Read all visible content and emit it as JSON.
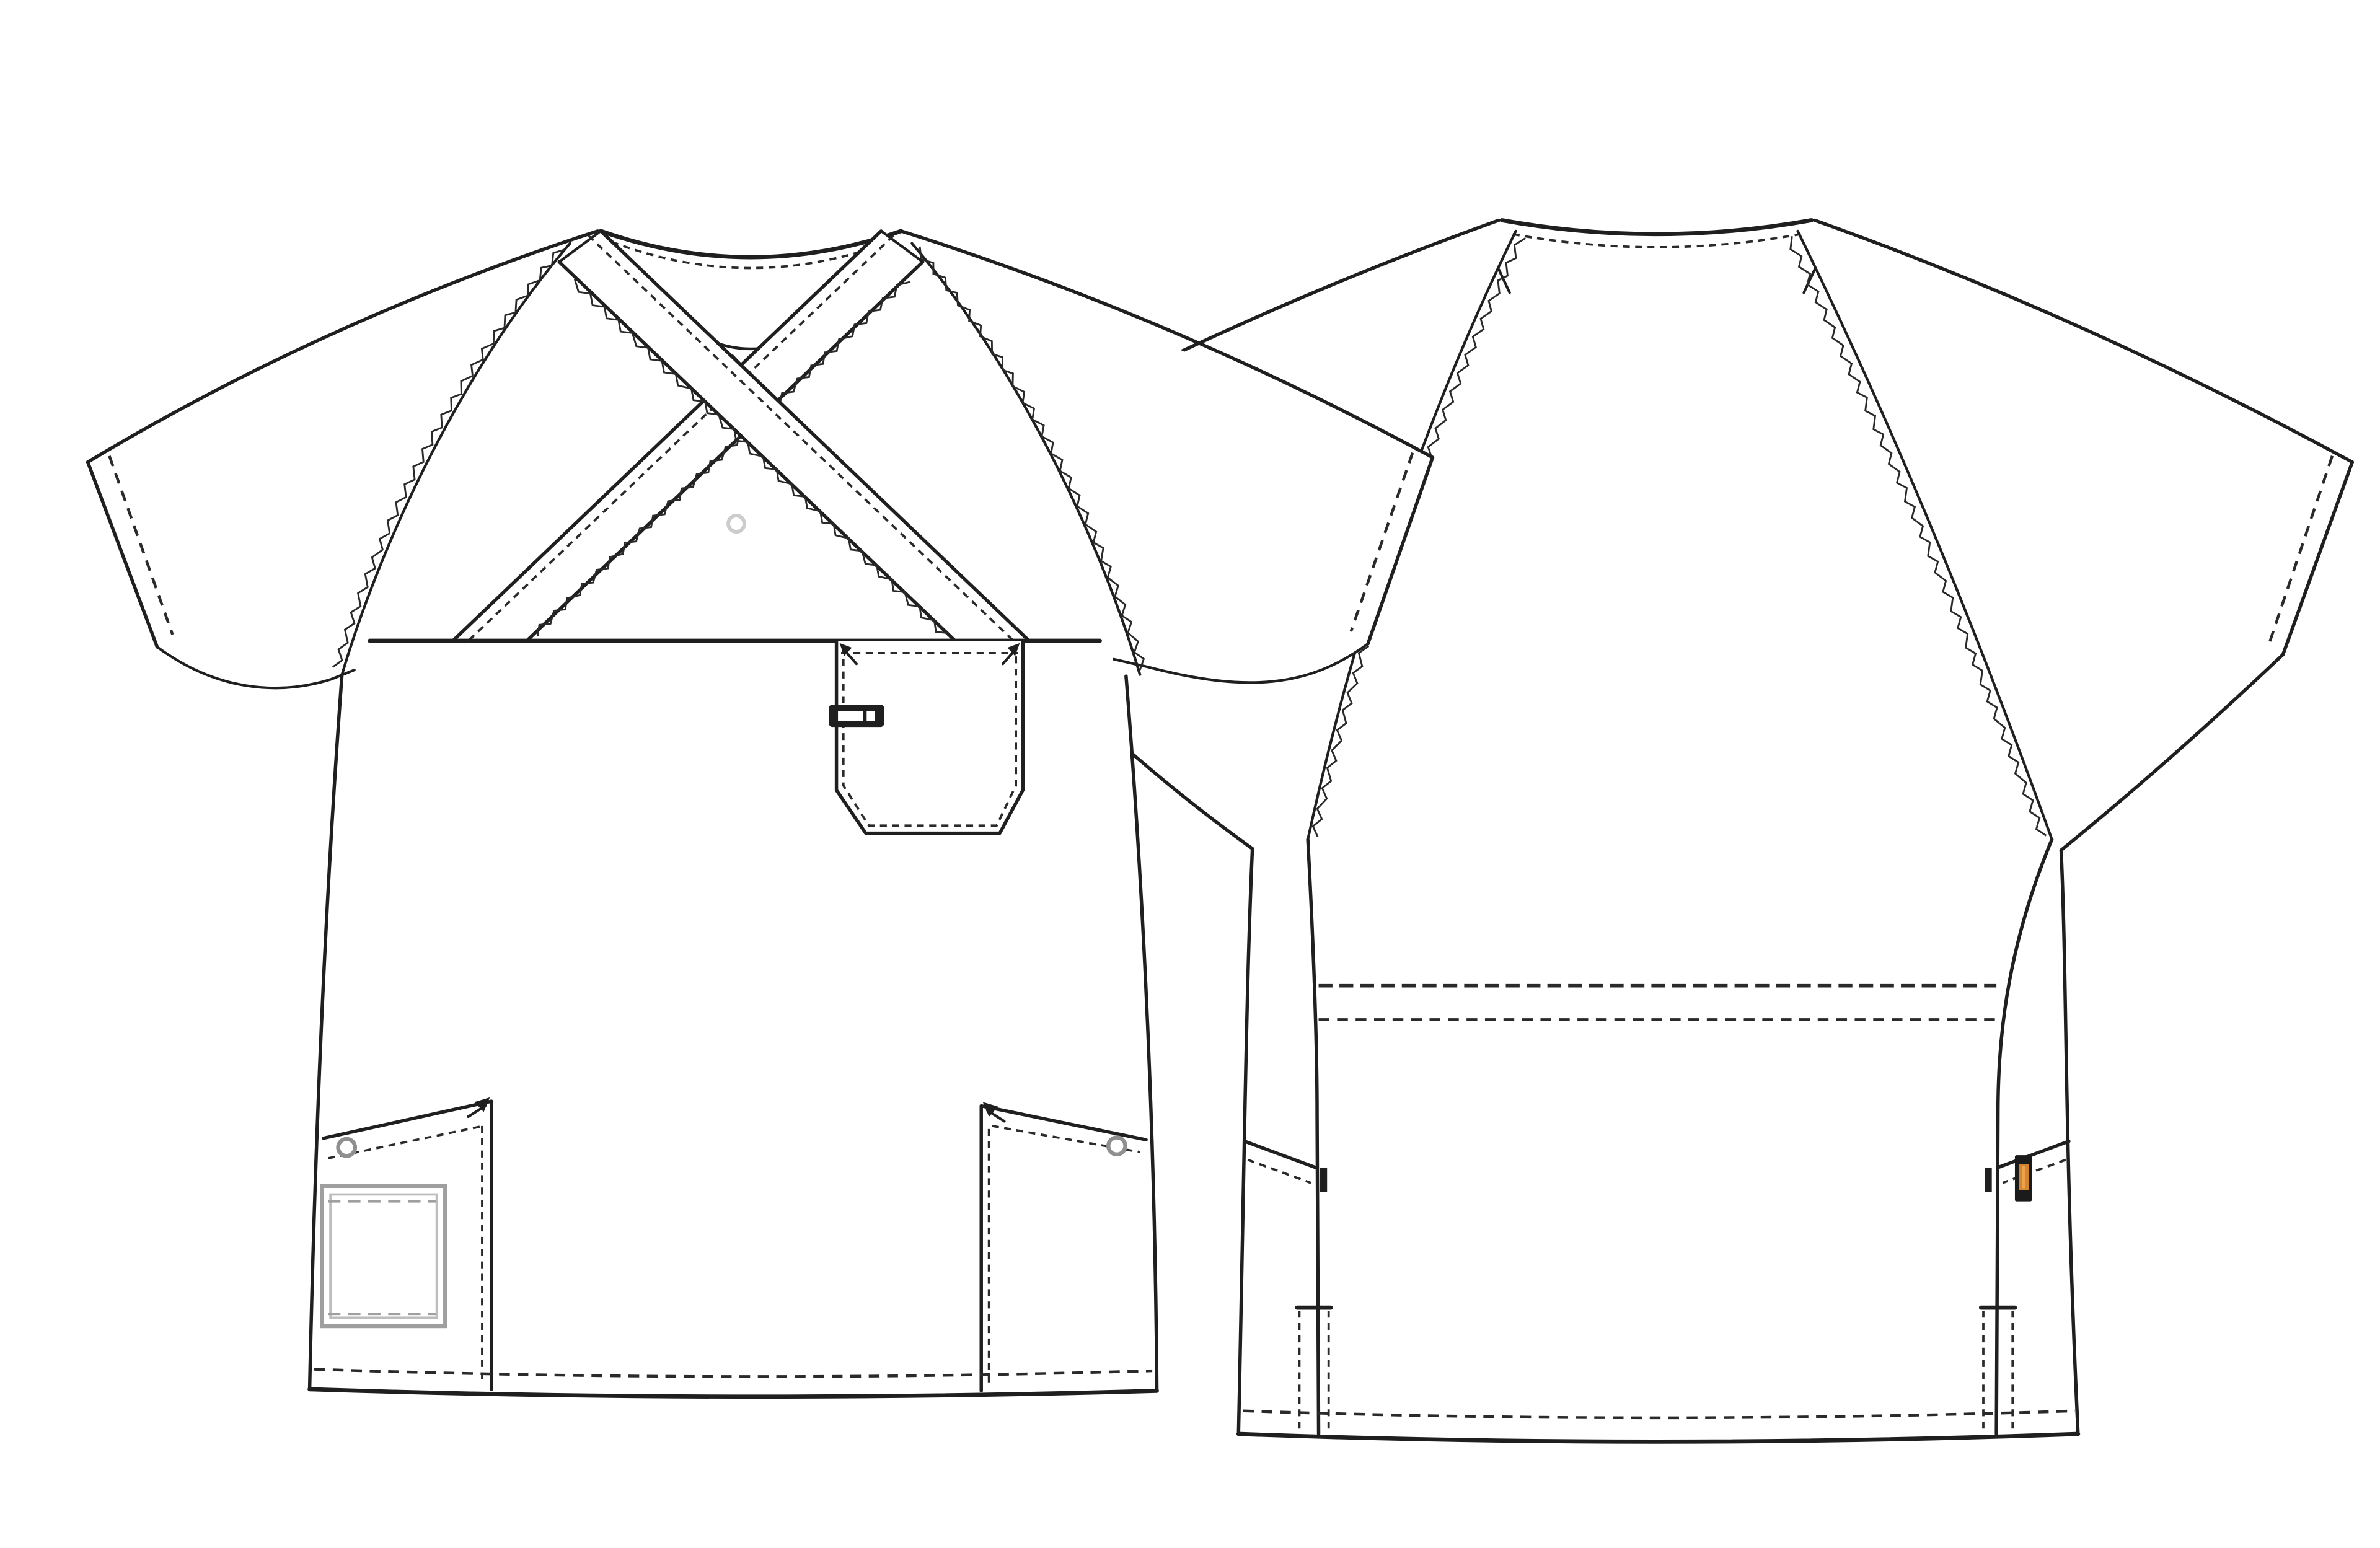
{
  "page": {
    "title": "scrub-top-technical-flat",
    "background": "#ffffff"
  },
  "colors": {
    "paper": "#ffffff",
    "ink": "#1f1f1f",
    "stitch": "#2a2a2a",
    "soft_gray": "#9f9f9f",
    "lighter_gray": "#bdbdbd",
    "snap_gray": "#cccccc",
    "rivet_gray": "#8f8f8f",
    "label_black": "#1b1b1b",
    "label_orange": "#d4862f",
    "label_orange_core": "#eda24e"
  },
  "views": [
    {
      "id": "front",
      "name": "front-view",
      "features": [
        "mock-wrap-crossover-neckline",
        "serged-raglan-seams",
        "snap-button",
        "yoke-seam",
        "chest-pocket-with-pen-slot",
        "bartack-arrows",
        "left-side-pocket-with-gray-inner-patch",
        "right-side-pocket",
        "rivets",
        "topstitched-hem",
        "short-raglan-sleeves"
      ]
    },
    {
      "id": "back",
      "name": "back-view",
      "features": [
        "back-neck-topstitch",
        "shoulder-notch-marks",
        "serged-raglan-seams",
        "side-panel-seams",
        "double-waist-topstitch",
        "side-pocket-openings",
        "bartacks",
        "orange-woven-label",
        "hem-vents",
        "topstitched-hem"
      ]
    }
  ]
}
